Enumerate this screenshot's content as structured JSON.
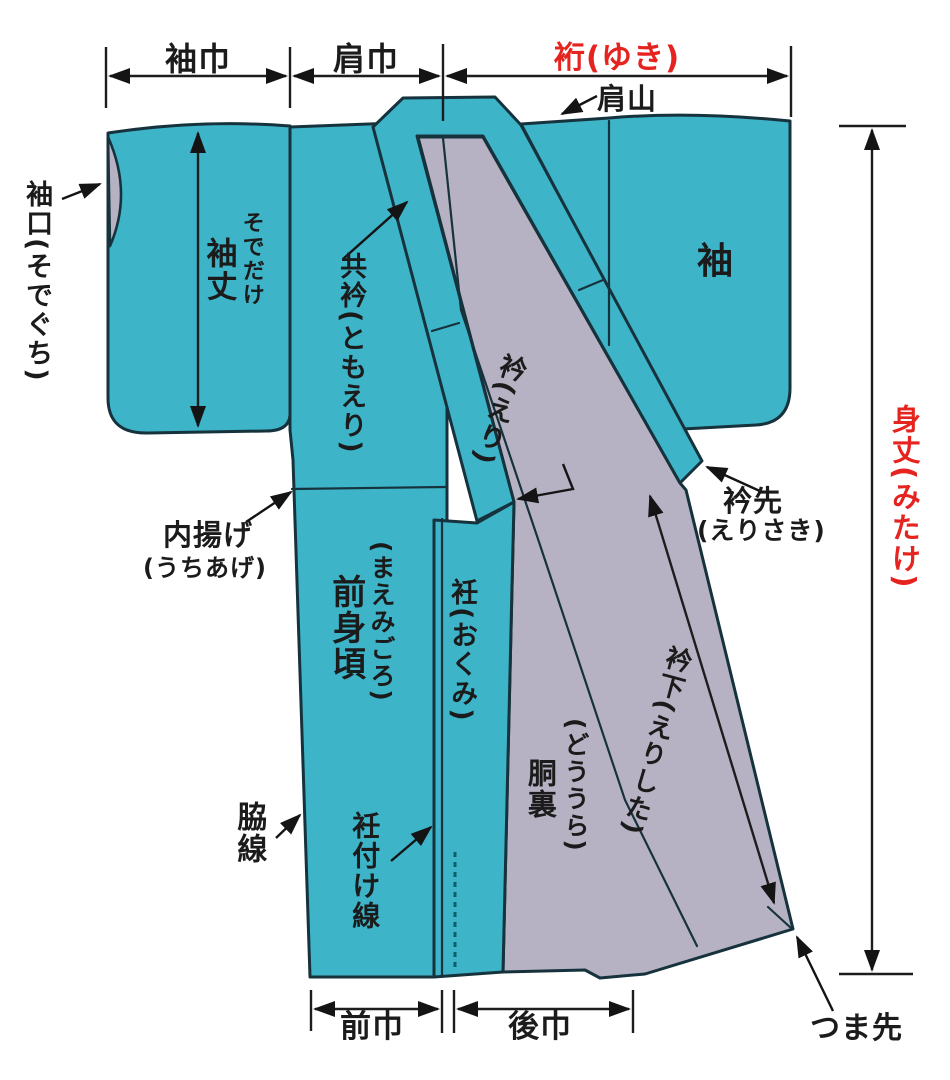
{
  "diagram": {
    "subject": "kimono-parts-diagram",
    "labels": {
      "sode_haba": "袖巾",
      "kata_haba": "肩巾",
      "yuki": "裄(ゆき)",
      "kata_yama": "肩山",
      "sode": "袖",
      "sode_guchi": "袖口(そでぐち)",
      "sode_take_kana": "そでだけ",
      "sode_take": "袖丈",
      "tomo_eri": "共衿(ともえり)",
      "eri": "衿(えり)",
      "uchiage": "内揚げ",
      "uchiage_kana": "(うちあげ)",
      "mae_migoro_kana": "(まえみごろ)",
      "mae_migoro": "前身頃",
      "okumi": "衽(おくみ)",
      "dou_ura_kana": "(どううら)",
      "dou_ura": "胴裏",
      "eri_shita": "衿下(えりした)",
      "eri_saki": "衿先",
      "eri_saki_kana": "(えりさき)",
      "waki_sen": "脇線",
      "okumi_tsuke_sen": "衽付け線",
      "mae_haba": "前巾",
      "ushiro_haba": "後巾",
      "tsuma_saki": "つま先",
      "mitake": "身丈(みたけ)"
    },
    "colors": {
      "fabric_teal": "#3db4c8",
      "lining_gray": "#b7b2c3",
      "outline_dark": "#16323d",
      "dimension_line": "#1d1d1d",
      "accent_red": "#e5231f",
      "label_text": "#1b1b1b",
      "background": "#ffffff"
    }
  }
}
